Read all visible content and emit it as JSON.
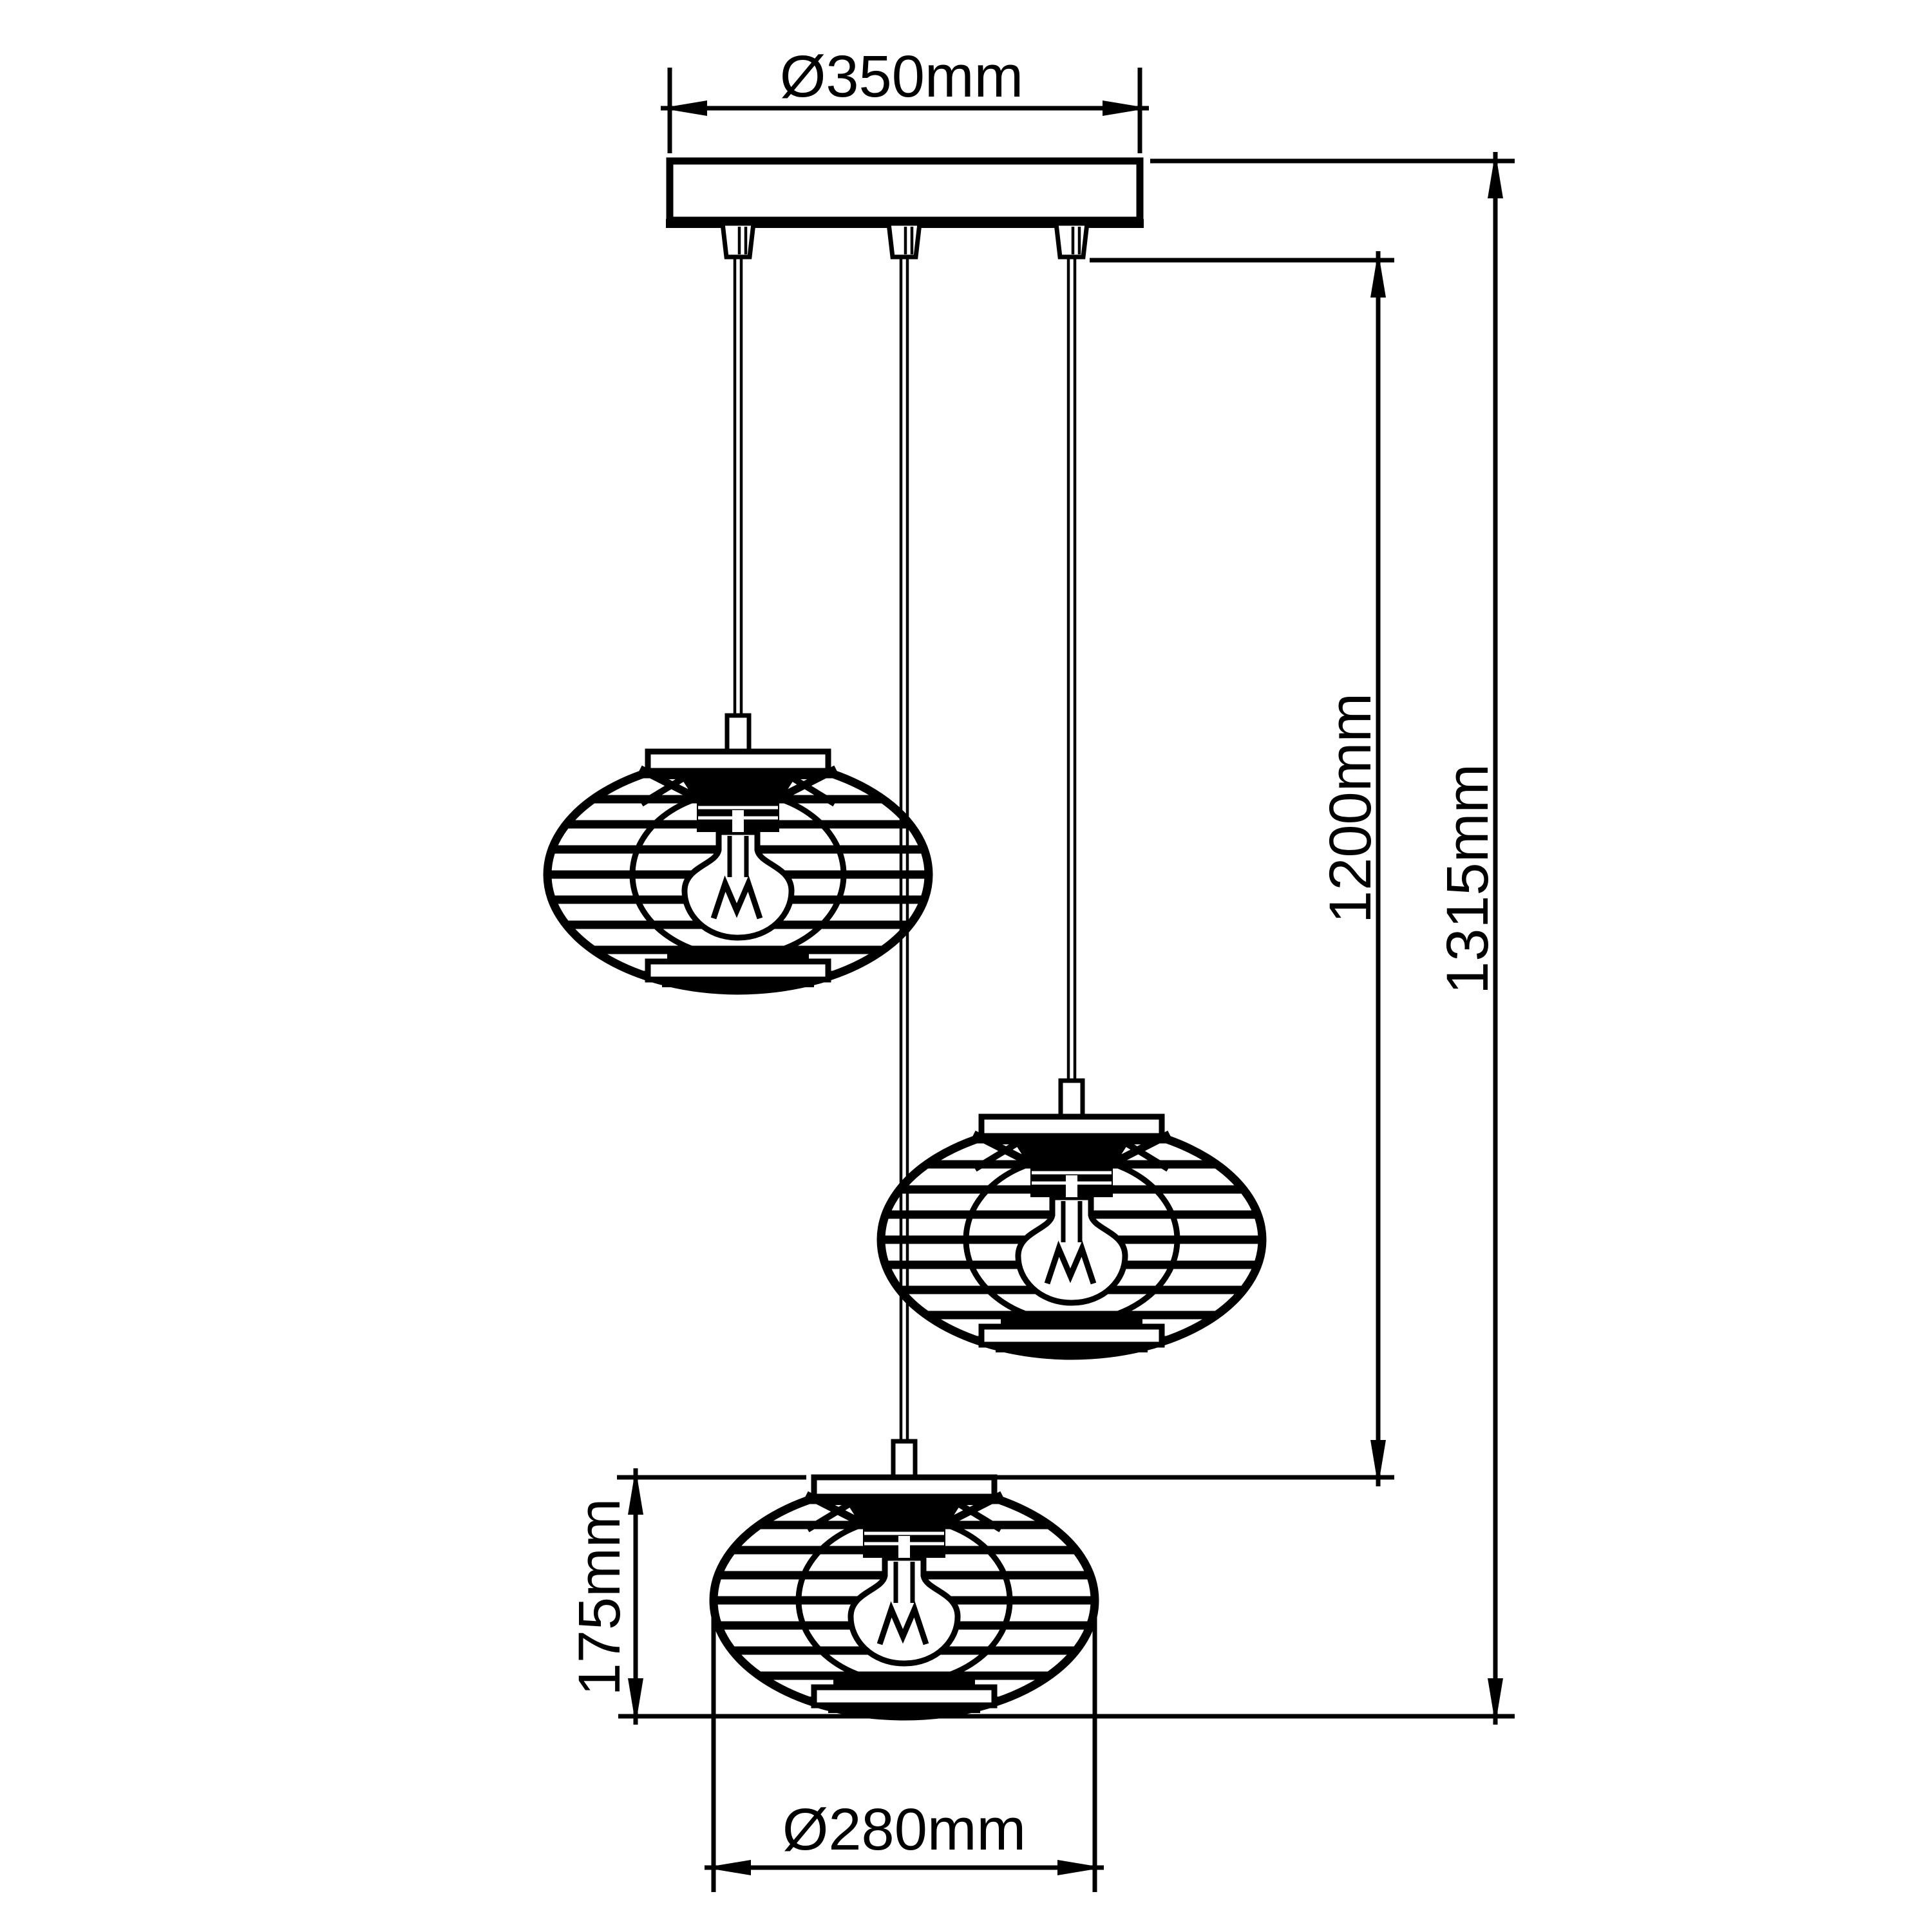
{
  "drawing": {
    "type": "pendant-lamp-dimension-diagram",
    "background_color": "#ffffff",
    "line_color": "#000000",
    "dimensions": {
      "canopy_diameter": {
        "label": "Ø350mm",
        "value_mm": 350,
        "orientation": "horizontal",
        "location": "top"
      },
      "drop_length": {
        "label": "1200mm",
        "value_mm": 1200,
        "orientation": "vertical",
        "location": "right-inner"
      },
      "total_height": {
        "label": "1315mm",
        "value_mm": 1315,
        "orientation": "vertical",
        "location": "right-outer"
      },
      "shade_height": {
        "label": "175mm",
        "value_mm": 175,
        "orientation": "vertical",
        "location": "bottom-left"
      },
      "shade_diameter": {
        "label": "Ø280mm",
        "value_mm": 280,
        "orientation": "horizontal",
        "location": "bottom"
      }
    },
    "components": {
      "canopy_count": 1,
      "cord_count": 3,
      "shade_count": 3,
      "bulb_count": 3
    }
  }
}
